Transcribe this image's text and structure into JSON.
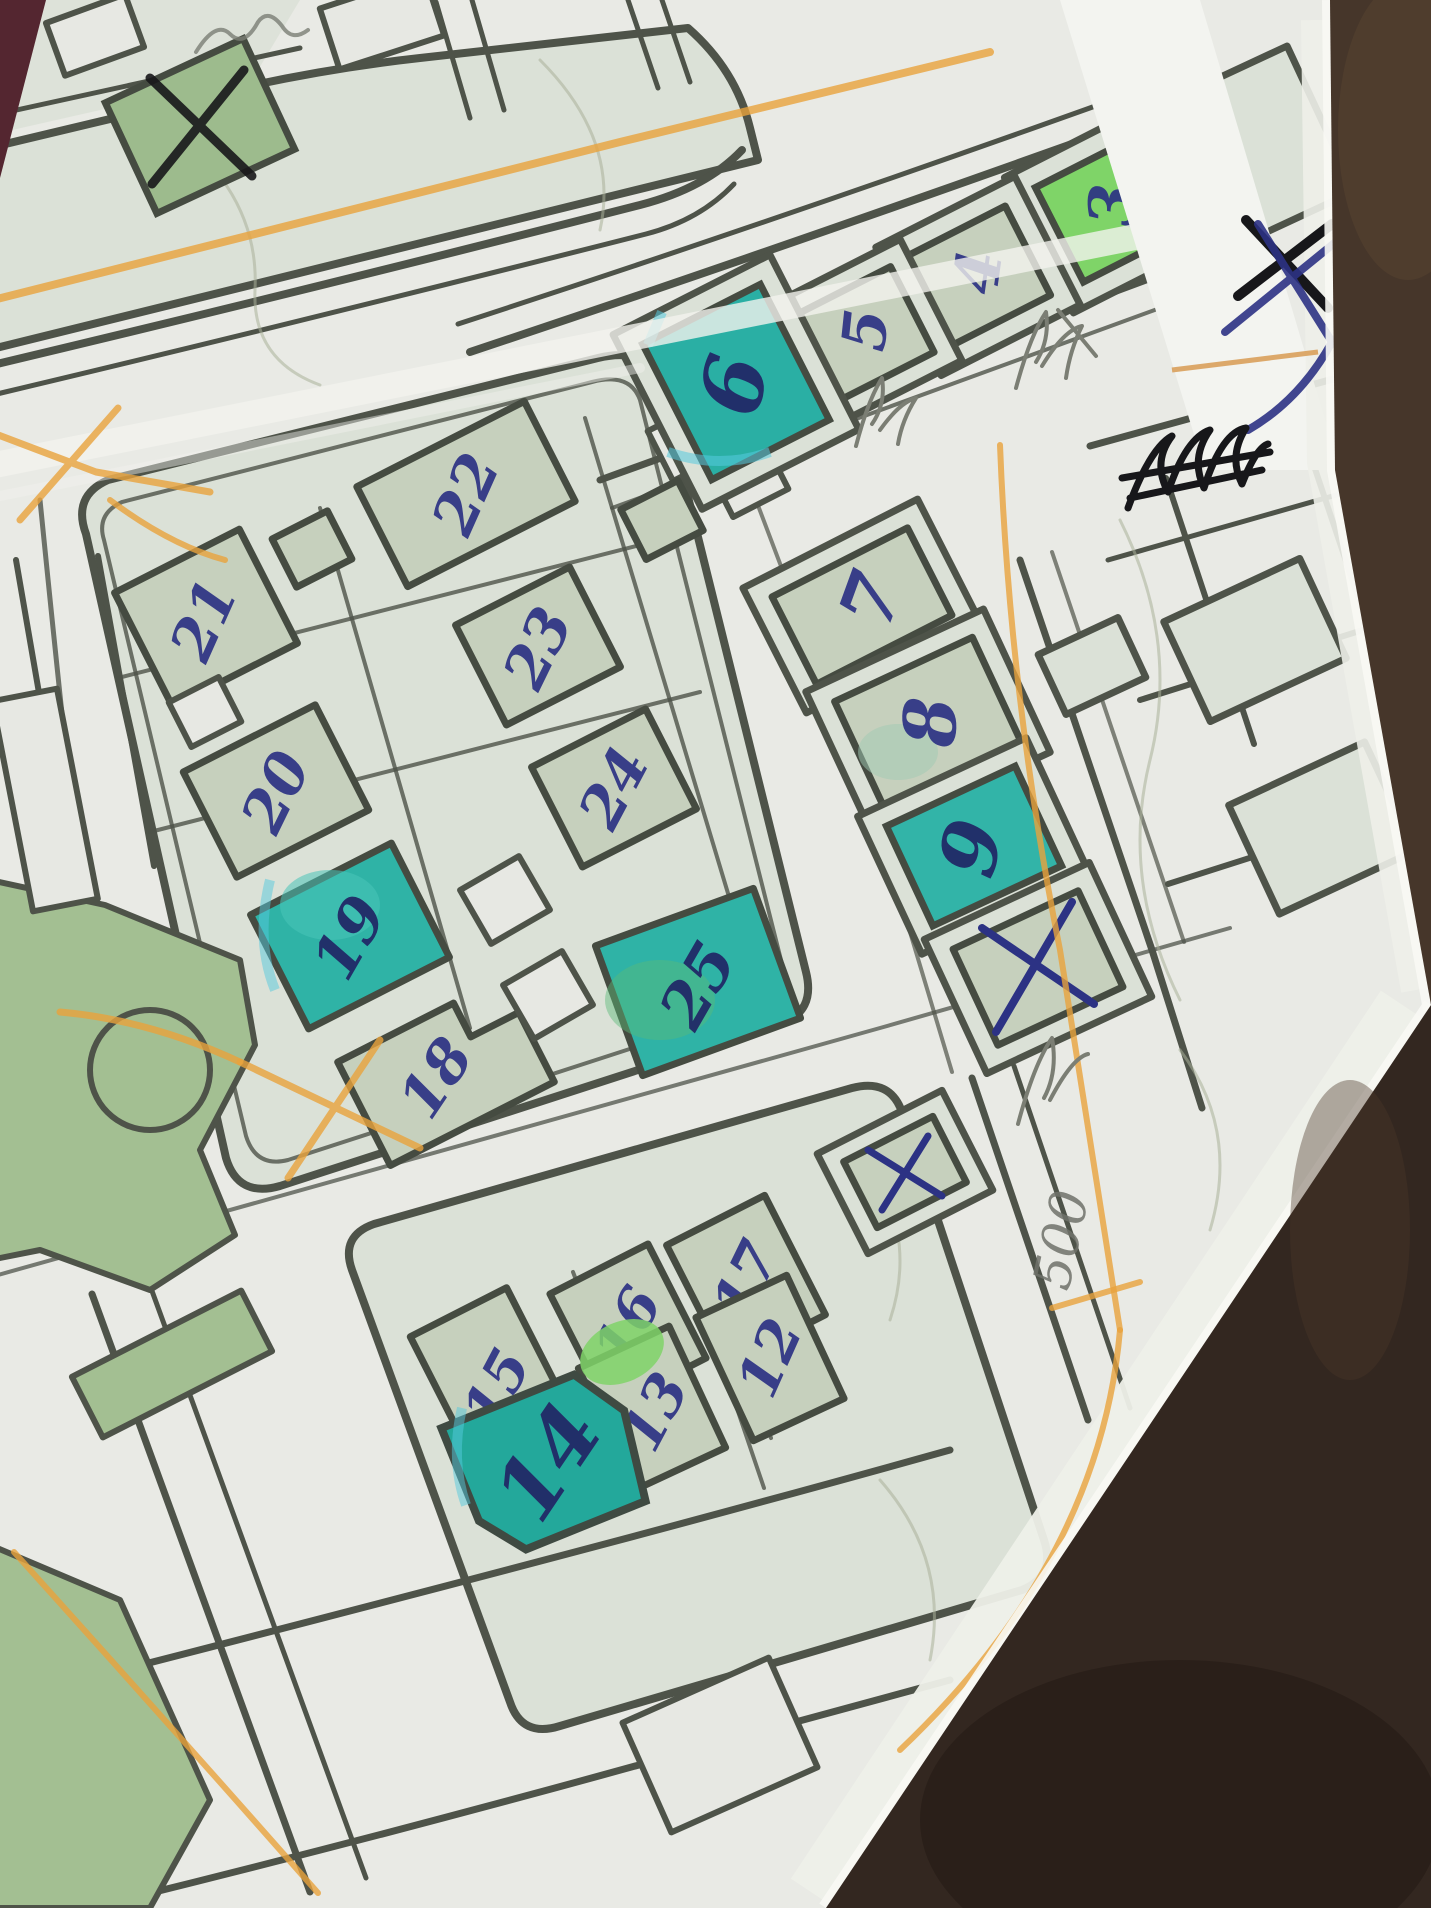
{
  "photo": {
    "type": "photograph",
    "scene": "hand-annotated printed street map lying on a dark brown leather surface",
    "paper": "white folded map sheet with a horizontal crease"
  },
  "colors": {
    "leather": "#3a2c22",
    "paper": "#e9eae5",
    "block_tint": "#dbe1d7",
    "building_fill": "#c6d0bd",
    "park_green": "#a3bf92",
    "bright_green": "#7fd468",
    "teal_highlight": "#2fb3a6",
    "street_line": "#4e5349",
    "pen_blue": "#2c3284",
    "pen_black": "#17171a",
    "pencil_gray": "#7b7e74",
    "route_orange": "#e8a33c"
  },
  "map": {
    "buildings": {
      "3": {
        "label": "3",
        "highlight": "bright-green"
      },
      "4": {
        "label": "4",
        "highlight": "none"
      },
      "5": {
        "label": "5",
        "highlight": "none"
      },
      "6": {
        "label": "6",
        "highlight": "teal"
      },
      "7": {
        "label": "7",
        "highlight": "none"
      },
      "8": {
        "label": "8",
        "highlight": "none"
      },
      "9": {
        "label": "9",
        "highlight": "teal"
      },
      "12": {
        "label": "12",
        "highlight": "none"
      },
      "13": {
        "label": "13",
        "highlight": "partial-green"
      },
      "14": {
        "label": "14",
        "highlight": "teal"
      },
      "15": {
        "label": "15",
        "highlight": "none"
      },
      "16": {
        "label": "16",
        "highlight": "none"
      },
      "17": {
        "label": "17",
        "highlight": "none"
      },
      "18": {
        "label": "18",
        "highlight": "none"
      },
      "19": {
        "label": "19",
        "highlight": "teal"
      },
      "20": {
        "label": "20",
        "highlight": "none"
      },
      "21": {
        "label": "21",
        "highlight": "none"
      },
      "22": {
        "label": "22",
        "highlight": "none"
      },
      "23": {
        "label": "23",
        "highlight": "none"
      },
      "24": {
        "label": "24",
        "highlight": "none"
      },
      "25": {
        "label": "25",
        "highlight": "teal"
      }
    },
    "cross_marks": [
      {
        "location": "green building top-left",
        "pen": "black"
      },
      {
        "location": "building below 9",
        "pen": "blue"
      },
      {
        "location": "small building near 17",
        "pen": "blue"
      },
      {
        "location": "top-right paper margin",
        "pen": "black and blue double X"
      }
    ],
    "scribbles": [
      {
        "location": "top-right margin below X",
        "pen": "black",
        "legible": false
      },
      {
        "location": "near buildings 4 and 5",
        "pen": "pencil",
        "legible": false
      },
      {
        "location": "top-left corner",
        "pen": "pencil",
        "legible": false
      },
      {
        "location": "right margin above note",
        "pen": "pencil",
        "legible": false
      }
    ],
    "notes": {
      "distance": "500"
    }
  }
}
